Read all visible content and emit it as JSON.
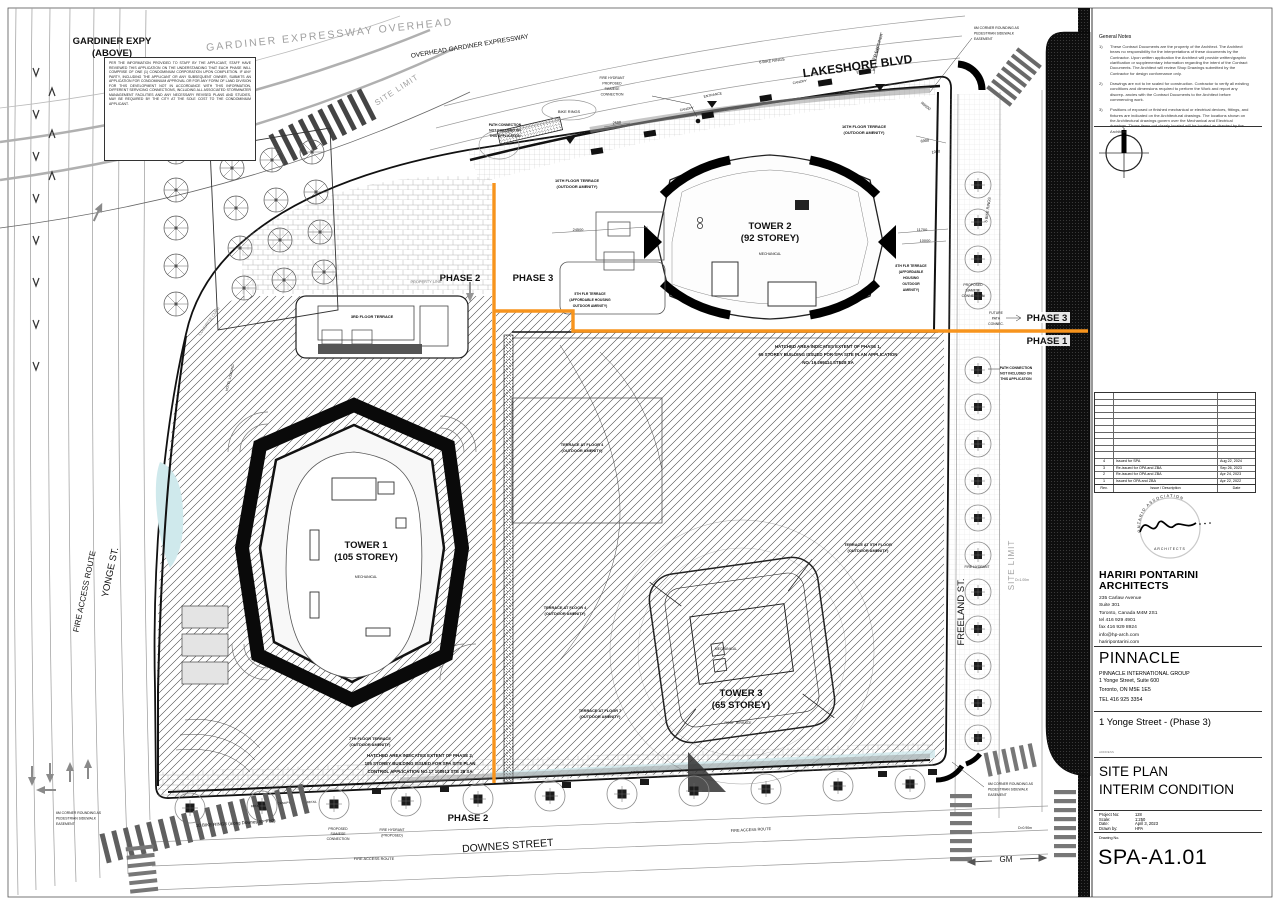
{
  "plan": {
    "streets": {
      "lakeshore": "LAKESHORE BLVD",
      "downes": "DOWNES STREET",
      "yonge": "YONGE ST.",
      "freeland": "FREELAND ST.",
      "fire_access_route": "FIRE ACCESS ROUTE",
      "overhead_gardiner": "OVERHEAD GARDINER EXPRESSWAY",
      "gardiner_gray": "GARDINER EXPRESSWAY OVERHEAD",
      "gardiner_expy": "GARDINER EXPY",
      "gardiner_above": "(ABOVE)",
      "to_gardiner": "TO GARDINER",
      "site_limit": "SITE LIMIT",
      "concrete_curb": "CONCRETE CURB",
      "gm": "GM"
    },
    "phases": {
      "phase1": "PHASE 1",
      "phase2": "PHASE 2",
      "phase3": "PHASE 3"
    },
    "towers": {
      "tower1_name": "TOWER 1",
      "tower1_storeys": "(105 STOREY)",
      "tower2_name": "TOWER 2",
      "tower2_storeys": "(92 STOREY)",
      "tower3_name": "TOWER 3",
      "tower3_storeys": "(65 STOREY)",
      "mechanical": "MECHANICAL",
      "roof_terrace": "ROOF TERRACE"
    },
    "area_notes": {
      "gardiner_note": "PER THE INFORMATION PROVIDED TO STAFF BY THE APPLICANT, STAFF HAVE REVIEWED THIS APPLICATION ON THE UNDERSTANDING THAT EACH PHASE WILL COMPRISE OF ONE (1) CONDOMINIUM CORPORATION UPON COMPLETION. IF ANY PARTY, INCLUDING THE APPLICANT OR ANY SUBSEQUENT OWNER, SUBMITS AN APPLICATION FOR CONDOMINIUM APPROVAL OR FOR ANY FORM OF LAND DIVISION FOR THIS DEVELOPMENT NOT IN ACCORDANCE WITH THIS INFORMATION, DIFFERENT SERVICING CONNECTIONS, INCLUDING ALL ASSOCIATED STORMWATER MANAGEMENT FACILITIES AND ANY NECESSARY REVISED PLANS AND STUDIES, MAY BE REQUIRED BY THE CITY AT THE SOLE COST TO THE CONDOMINIUM APPLICANT.",
      "hatch_phase1": [
        "HATCHED AREA INDICATES EXTENT OF PHASE 1,",
        "65 STOREY BUILDING ISSUED FOR SPA SITE PLAN APPLICATION",
        "NO. 16 269114 STE28 SA"
      ],
      "hatch_phase2": [
        "HATCHED AREA INDICATES EXTENT OF PHASE 2,",
        "105 STOREY BUILDING ISSUED FOR SPA SITE PLAN",
        "CONTROL APPLICATION NO.17 108913 STE 28 SA"
      ],
      "path_connection": [
        "PATH CONNECTION",
        "NOT INCLUDED ON",
        "THIS APPLICATION"
      ],
      "future_path": [
        "FUTURE",
        "PATH",
        "CONNEC."
      ],
      "corner_rounding": [
        "6M CORNER ROUNDING AS",
        "PEDESTRIAN SIDEWALK",
        "EASEMENT"
      ],
      "fire_hydrant_siamese": [
        "FIRE HYDRANT",
        "PROPOSED",
        "SIAMESE",
        "CONNECTION"
      ],
      "proposed_siamese": [
        "PROPOSED",
        "SIAMESE",
        "CONNECTION"
      ],
      "fire_hydrant_proposed": [
        "FIRE HYDRANT",
        "(PROPOSED)"
      ],
      "fire_hydrant": "FIRE HYDRANT",
      "bike_rings": "BIKE RINGS",
      "bike_rings_6": "6 BIKE RINGS",
      "bike_rings_10": "10 BIKE RINGS (along Downes St- PH2)",
      "canopy": "CANOPY",
      "metal_canopy": "METAL CANOPY",
      "entrance": "ENTRANCE",
      "retail": "RETAIL",
      "hotel_loading": "HOTEL LOADING",
      "property_line": "PROPERTY LINE",
      "d090": "D=0.90m",
      "d100": "D=1.00m"
    },
    "terraces": {
      "t3": "3RD FLOOR TERRACE",
      "t10": [
        "10TH FLOOR TERRACE",
        "(OUTDOOR AMENITY)"
      ],
      "t16": [
        "16TH FLOOR TERRACE",
        "(OUTDOOR AMENITY)"
      ],
      "t8": [
        "8TH FLR TERRACE",
        "(AFFORDABLE",
        "HOUSING",
        "OUTDOOR",
        "AMENITY)"
      ],
      "t5_aff": [
        "5TH FLR TERRACE",
        "(AFFORDABLE HOUSING",
        "OUTDOOR AMENITY)"
      ],
      "t4": [
        "TERRACE AT FLOOR 4",
        "(OUTDOOR AMENITY)"
      ],
      "t5": [
        "TERRACE AT 5TH FLOOR",
        "(OUTDOOR AMENITY)"
      ],
      "t7": [
        "7TH FLOOR TERRACE",
        "(OUTDOOR AMENITY)"
      ],
      "t7b": [
        "TERRACE AT FLOOR 7",
        "(OUTDOOR AMENITY)"
      ]
    },
    "dimensions": {
      "d24500": "24500",
      "d11700": "11700",
      "d10000": "10000",
      "d6900": "6900",
      "d1000": "1000",
      "d15100": "15100",
      "r6000": "R6000",
      "d2500": "2500"
    },
    "colors": {
      "phase_line": "#F7941D",
      "water": "#cfe9ec"
    }
  },
  "titleblock": {
    "general_notes_title": "General Notes",
    "general_notes": [
      {
        "num": "1)",
        "text": "These Contract Documents are the property of the Architect. The Architect bears no responsibility for the interpretations of these documents by the Contractor. Upon written application the Architect will provide written/graphic clarification or supplementary information regarding the intent of the Contract Documents. The Architect will review Shop Drawings submitted by the Contractor for design conformance only."
      },
      {
        "num": "2)",
        "text": "Drawings are not to be scaled for construction. Contractor to verify all existing conditions and dimensions required to perform the Work and report any discrep- ancies with the Contract Documents to the Architect before commencing work."
      },
      {
        "num": "3)",
        "text": "Positions of exposed or finished mechanical or electrical devices, fittings, and fixtures are indicated on the Architectural drawings. The locations shown on the Architectural drawings govern over the Mechanical and Electrical drawings. Those items not clearly located will be located as directed by the Architect."
      }
    ],
    "revisions": {
      "header": {
        "rev": "Rev.",
        "desc": "Issue / Description",
        "date": "Date"
      },
      "rows": [
        {
          "rev": "4",
          "desc": "Issued for SPA",
          "date": "Aug 22, 2024"
        },
        {
          "rev": "3",
          "desc": "Re-issued for OPA and ZBA",
          "date": "Sep 26, 2023"
        },
        {
          "rev": "2",
          "desc": "Re-issued for OPA and ZBA",
          "date": "Apr 24, 2023"
        },
        {
          "rev": "1",
          "desc": "Issued for OPA and ZBA",
          "date": "Apr 22, 2022"
        }
      ]
    },
    "stamp": {
      "arc": "ONTARIO ASSOCIATION",
      "mid": "ARCHITECTS"
    },
    "architect": {
      "name1": "HARIRI PONTARINI",
      "name2": "ARCHITECTS",
      "lines": [
        "235 Carlaw Avenue",
        "Suite 301",
        "Toronto, Canada M4M 2S1",
        "tel  416 929 4901",
        "fax 416 929 8924",
        "info@hp-arch.com",
        "hariripontarini.com"
      ]
    },
    "client": {
      "name": "PINNACLE",
      "sub": "PINNACLE INTERNATIONAL GROUP",
      "lines": [
        "1 Yonge Street, Suite 600",
        "Toronto, ON  M5E 1E5",
        "TEL 416 925 3354"
      ]
    },
    "project_title": "1 Yonge Street - (Phase 3)",
    "address_label": "ADDRESS",
    "sheet_title1": "SITE PLAN",
    "sheet_title2": "INTERIM CONDITION",
    "info": {
      "project_no_label": "Project No:",
      "project_no": "128",
      "scale_label": "Scale:",
      "scale": "1:250",
      "date_label": "Date:",
      "date": "April 3, 2023",
      "drawn_label": "Drawn by:",
      "drawn": "HPA",
      "drawing_no_label": "Drawing No.",
      "drawing_no": "SPA-A1.01"
    }
  }
}
